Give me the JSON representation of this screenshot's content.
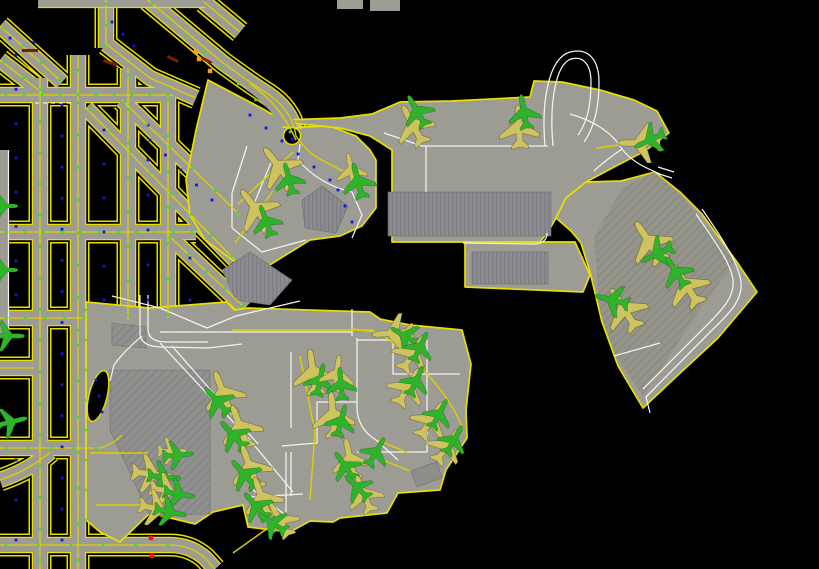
{
  "scene": {
    "width": 819,
    "height": 569,
    "background": "#000000",
    "description": "airport-surface-movement-ground-map"
  },
  "colors": {
    "pavement": "#a0a098",
    "pavement_dark": "#8f8f8a",
    "building": "#8b8b90",
    "edge_yellow": "#e8df00",
    "taxi_line_yellow": "#ddd000",
    "road_white": "#f2f2f2",
    "light_blue": "#1414e6",
    "light_green": "#3fd83f",
    "light_orange": "#ff9d18",
    "stopbar_dark_red": "#7a1e00",
    "marker_red": "#ff1111",
    "aircraft_heavy": "#cfc360",
    "aircraft_light": "#2fb32a"
  },
  "aircraft": [
    [
      "y",
      279,
      167,
      -38,
      1.15
    ],
    [
      "g",
      289,
      179,
      -15,
      0.8
    ],
    [
      "y",
      256,
      209,
      -38,
      1.15
    ],
    [
      "g",
      266,
      221,
      -20,
      0.8
    ],
    [
      "y",
      351,
      170,
      -10,
      0.8
    ],
    [
      "g",
      358,
      181,
      -15,
      0.88
    ],
    [
      "y",
      413,
      125,
      -28,
      1.05
    ],
    [
      "g",
      417,
      111,
      -30,
      0.85
    ],
    [
      "y",
      519,
      127,
      -3,
      1.05
    ],
    [
      "g",
      524,
      112,
      -10,
      0.85
    ],
    [
      "y",
      640,
      143,
      -90,
      1.05
    ],
    [
      "g",
      650,
      140,
      -115,
      0.8
    ],
    [
      "y",
      649,
      242,
      -33,
      1.15
    ],
    [
      "g",
      657,
      254,
      -115,
      0.85
    ],
    [
      "y",
      686,
      285,
      -33,
      1.15
    ],
    [
      "g",
      676,
      272,
      -33,
      0.85
    ],
    [
      "y",
      624,
      309,
      -33,
      1.15
    ],
    [
      "g",
      612,
      300,
      -75,
      0.85
    ],
    [
      "y",
      393,
      333,
      -95,
      1.0
    ],
    [
      "g",
      405,
      336,
      -60,
      0.78
    ],
    [
      "y",
      413,
      353,
      32,
      1.0
    ],
    [
      "g",
      420,
      347,
      25,
      0.78
    ],
    [
      "y",
      408,
      387,
      30,
      1.0
    ],
    [
      "g",
      416,
      381,
      25,
      0.78
    ],
    [
      "y",
      431,
      420,
      33,
      1.0
    ],
    [
      "g",
      439,
      414,
      28,
      0.78
    ],
    [
      "y",
      447,
      446,
      35,
      0.95
    ],
    [
      "g",
      454,
      440,
      30,
      0.78
    ],
    [
      "y",
      313,
      372,
      -8,
      1.1
    ],
    [
      "g",
      320,
      380,
      12,
      0.8
    ],
    [
      "y",
      337,
      374,
      6,
      0.9
    ],
    [
      "g",
      341,
      384,
      -5,
      0.8
    ],
    [
      "y",
      333,
      415,
      -5,
      1.1
    ],
    [
      "g",
      341,
      421,
      15,
      0.8
    ],
    [
      "y",
      350,
      459,
      -12,
      1.0
    ],
    [
      "g",
      345,
      466,
      -35,
      0.8
    ],
    [
      "g",
      376,
      452,
      30,
      0.78
    ],
    [
      "y",
      364,
      494,
      -22,
      0.95
    ],
    [
      "g",
      357,
      487,
      -45,
      0.78
    ],
    [
      "y",
      223,
      393,
      -20,
      1.1
    ],
    [
      "g",
      217,
      401,
      -42,
      0.85
    ],
    [
      "y",
      240,
      427,
      -20,
      1.1
    ],
    [
      "g",
      233,
      435,
      -42,
      0.85
    ],
    [
      "y",
      250,
      467,
      -20,
      1.1
    ],
    [
      "g",
      244,
      474,
      -42,
      0.85
    ],
    [
      "y",
      262,
      498,
      -20,
      1.05
    ],
    [
      "g",
      256,
      506,
      -42,
      0.82
    ],
    [
      "y",
      280,
      520,
      -30,
      0.92
    ],
    [
      "g",
      272,
      523,
      -58,
      0.8
    ],
    [
      "y",
      152,
      474,
      96,
      1.0
    ],
    [
      "g",
      164,
      477,
      96,
      0.82
    ],
    [
      "y",
      172,
      451,
      90,
      0.7
    ],
    [
      "g",
      178,
      455,
      85,
      0.75
    ],
    [
      "y",
      168,
      491,
      100,
      0.9
    ],
    [
      "g",
      179,
      494,
      100,
      0.78
    ],
    [
      "y",
      158,
      509,
      102,
      0.95
    ],
    [
      "g",
      170,
      512,
      102,
      0.8
    ],
    [
      "g",
      8,
      336,
      90,
      0.8
    ],
    [
      "g",
      11,
      422,
      76,
      0.8
    ],
    [
      "g",
      3,
      206,
      90,
      0.72
    ],
    [
      "g",
      3,
      270,
      90,
      0.72
    ]
  ],
  "towlines": [
    [
      596,
      148,
      627,
      144
    ],
    [
      352,
      329,
      384,
      333
    ],
    [
      238,
      204,
      293,
      152
    ],
    [
      235,
      243,
      273,
      191
    ]
  ],
  "lights": {
    "blue_rows": [
      [
        62,
        105,
        62,
        540,
        15
      ],
      [
        104,
        130,
        104,
        300,
        6
      ],
      [
        16,
        55,
        16,
        295,
        8
      ],
      [
        16,
        420,
        16,
        540,
        4
      ],
      [
        148,
        125,
        148,
        300,
        6
      ],
      [
        190,
        258,
        190,
        300,
        2
      ],
      [
        150,
        140,
        212,
        200,
        5
      ],
      [
        250,
        115,
        330,
        180,
        6
      ],
      [
        96,
        380,
        102,
        412,
        3
      ],
      [
        338,
        190,
        352,
        222,
        3
      ],
      [
        10,
        38,
        34,
        42,
        2
      ],
      [
        112,
        22,
        134,
        46,
        3
      ],
      [
        292,
        139,
        292,
        139,
        1
      ]
    ],
    "green_rows": [
      [
        40,
        90,
        40,
        560,
        16
      ],
      [
        78,
        70,
        78,
        330,
        9
      ],
      [
        78,
        345,
        78,
        560,
        7
      ],
      [
        128,
        75,
        128,
        315,
        8
      ],
      [
        168,
        100,
        168,
        315,
        7
      ],
      [
        85,
        310,
        85,
        520,
        8
      ],
      [
        6,
        95,
        168,
        95,
        10
      ],
      [
        6,
        232,
        192,
        232,
        11
      ],
      [
        6,
        318,
        84,
        318,
        5
      ],
      [
        6,
        448,
        96,
        448,
        5
      ],
      [
        6,
        545,
        168,
        545,
        6
      ],
      [
        152,
        4,
        290,
        132,
        9
      ],
      [
        90,
        110,
        232,
        256,
        8
      ],
      [
        124,
        102,
        238,
        213,
        6
      ],
      [
        170,
        237,
        243,
        306,
        5
      ],
      [
        4,
        28,
        60,
        80,
        4
      ],
      [
        4,
        62,
        43,
        93,
        3
      ],
      [
        106,
        4,
        106,
        46,
        3
      ]
    ],
    "orange_points": [
      [
        196,
        52
      ],
      [
        199,
        59
      ],
      [
        210,
        71
      ]
    ],
    "red_points": [
      [
        151,
        538
      ],
      [
        152,
        556
      ]
    ],
    "stopbars": [
      [
        22,
        49,
        16,
        3,
        0
      ],
      [
        104,
        59,
        14,
        3,
        20
      ],
      [
        168,
        55,
        12,
        3,
        25
      ],
      [
        202,
        56,
        12,
        3,
        30
      ]
    ]
  }
}
